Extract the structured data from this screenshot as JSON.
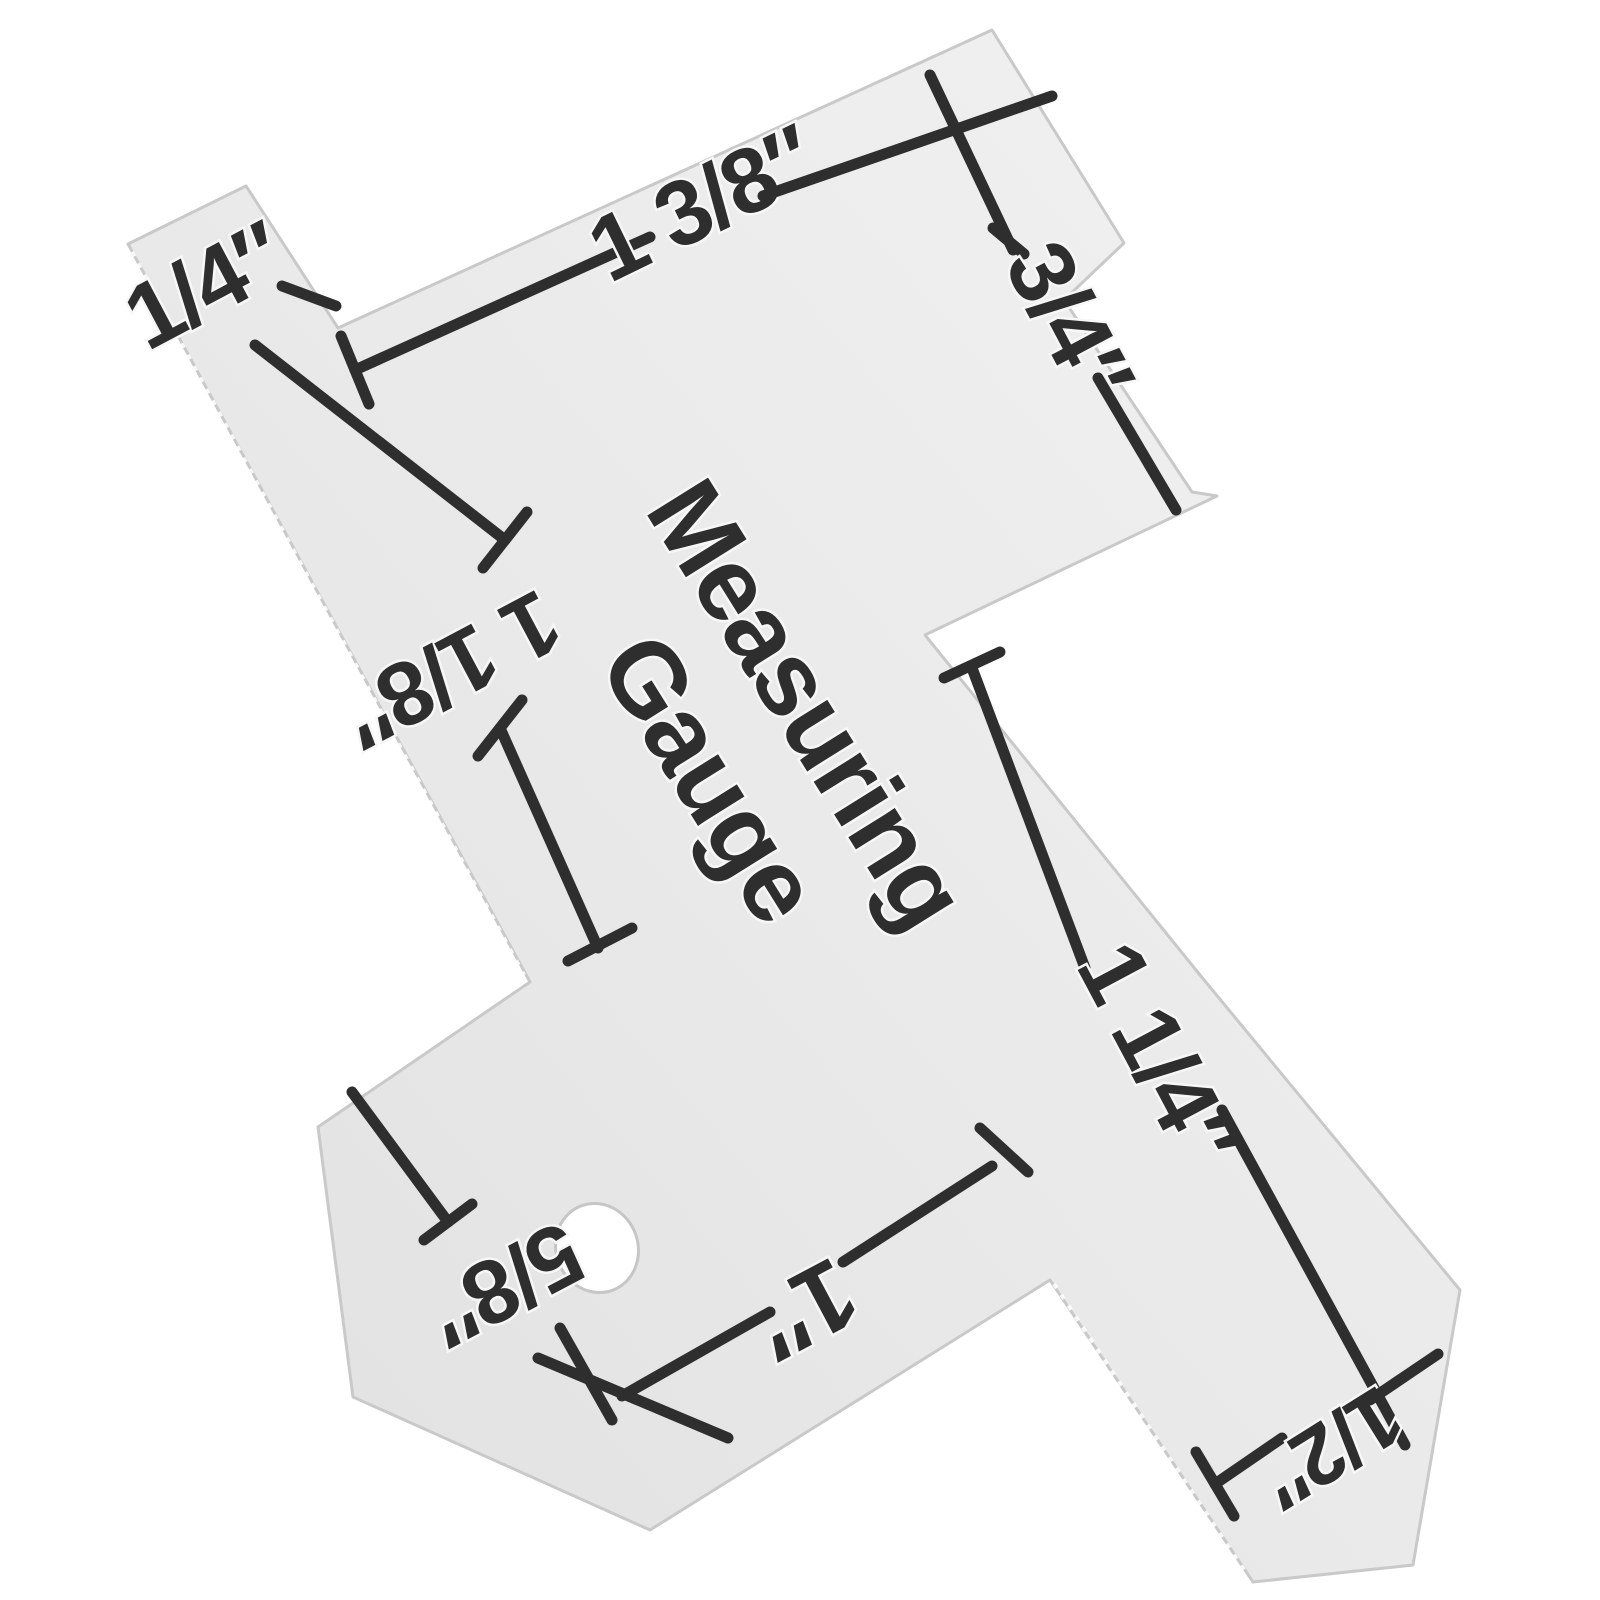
{
  "scene": {
    "type": "product-photo",
    "background_color": "#ffffff",
    "subject": "Metal sewing measuring gauge photographed at an angle on a white background"
  },
  "gauge": {
    "plate_color": "#e9e9e9",
    "marking_color": "#2e2e2e",
    "title": {
      "line1": "Measuring",
      "line2": "Gauge"
    },
    "markings": {
      "quarter_inch": "1/4″",
      "one_and_three_eighths": "1 3/8″",
      "three_quarters": "3/4″",
      "one_and_one_eighth": "1 1/8″",
      "one_and_one_quarter": "1 1/4″",
      "one_inch": "1″",
      "five_eighths": "5/8″",
      "half_inch": "1/2″"
    }
  }
}
